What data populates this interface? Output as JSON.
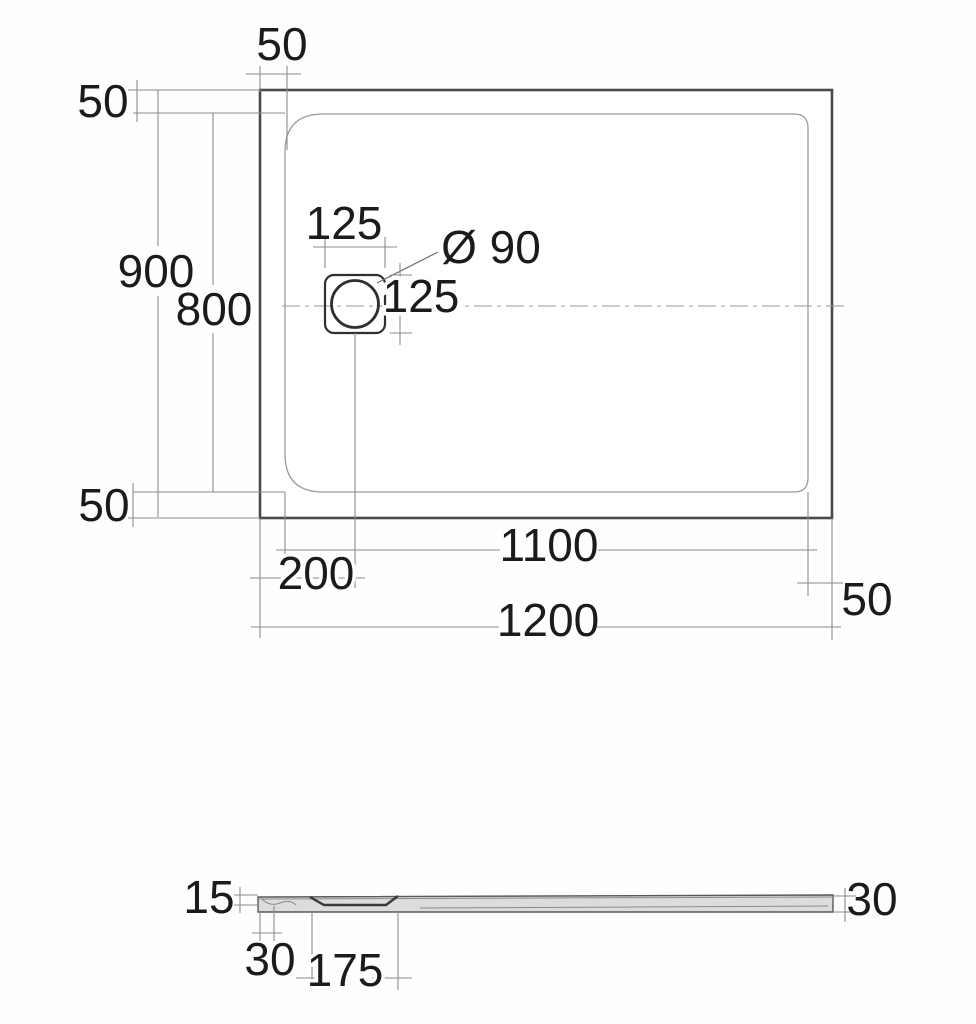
{
  "drawing_title": "shower-tray-dimension-drawing",
  "colors": {
    "outline": "#4a4a4a",
    "inner_edge": "#9b9b9b",
    "dimension_lines": "#8b8b8b",
    "text": "#1b1b1b",
    "profile_fill": "#dcdcdc",
    "drain_hatch": "#8f8f8f",
    "background": "#fefefe"
  },
  "plan_view": {
    "labels": {
      "inset_top": "50",
      "inset_left_top": "50",
      "overall_depth": "900",
      "inner_depth": "800",
      "inset_left_bottom": "50",
      "drain_flange_width": "125",
      "drain_diameter": "Ø 90",
      "drain_flange_height": "125",
      "drain_offset": "200",
      "inner_width": "1100",
      "overall_width": "1200",
      "inset_right": "50"
    }
  },
  "profile_view": {
    "labels": {
      "edge_height": "15",
      "edge_width": "30",
      "recess_width": "175",
      "end_height": "30"
    }
  }
}
